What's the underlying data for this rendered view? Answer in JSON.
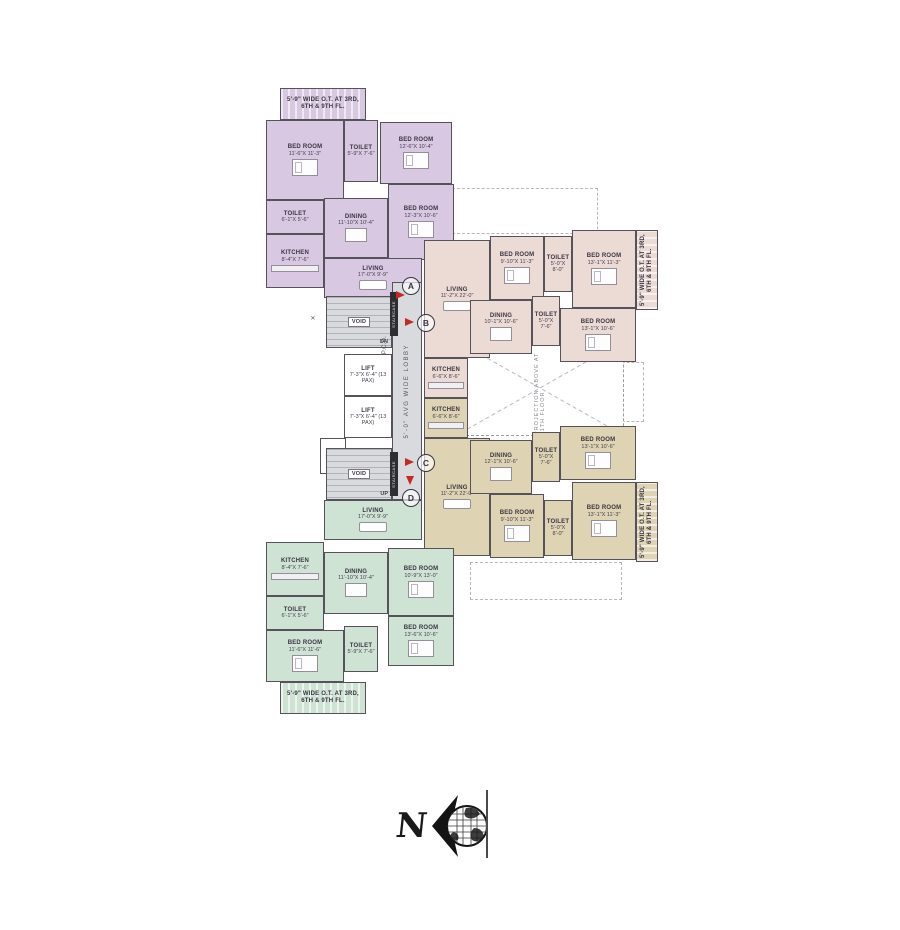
{
  "colors": {
    "purple": "#d9c8e1",
    "pink": "#ecdad5",
    "tan": "#ded3b2",
    "green": "#cfe3d5",
    "core": "#d8dadd",
    "wall": "#56525c",
    "arrow_red": "#c32a21"
  },
  "units": [
    {
      "id": "unit-a",
      "colorKey": "purple",
      "rooms": [
        {
          "name": "5'-9\" WIDE O.T. AT 3RD, 6TH & 9TH FL.",
          "dims": "",
          "type": "balcony",
          "x": 280,
          "y": 88,
          "w": 86,
          "h": 32
        },
        {
          "name": "BED ROOM",
          "dims": "11'-6\"X 11'-3\"",
          "type": "bedroom",
          "x": 266,
          "y": 120,
          "w": 78,
          "h": 80
        },
        {
          "name": "TOILET",
          "dims": "5'-9\"X 7'-6\"",
          "type": "toilet",
          "x": 344,
          "y": 120,
          "w": 34,
          "h": 62
        },
        {
          "name": "BED ROOM",
          "dims": "12'-6\"X 10'-4\"",
          "type": "bedroom",
          "x": 380,
          "y": 122,
          "w": 72,
          "h": 62
        },
        {
          "name": "TOILET",
          "dims": "6'-1\"X 5'-6\"",
          "type": "toilet",
          "x": 266,
          "y": 200,
          "w": 58,
          "h": 34
        },
        {
          "name": "KITCHEN",
          "dims": "8'-4\"X 7'-6\"",
          "type": "kitchen",
          "x": 266,
          "y": 234,
          "w": 58,
          "h": 54
        },
        {
          "name": "DINING",
          "dims": "11'-10\"X 10'-4\"",
          "type": "dining",
          "x": 324,
          "y": 198,
          "w": 64,
          "h": 60
        },
        {
          "name": "BED ROOM",
          "dims": "12'-3\"X 10'-6\"",
          "type": "bedroom",
          "x": 388,
          "y": 184,
          "w": 66,
          "h": 76
        },
        {
          "name": "LIVING",
          "dims": "17'-0\"X 9'-9\"",
          "type": "living",
          "x": 324,
          "y": 258,
          "w": 98,
          "h": 40
        }
      ]
    },
    {
      "id": "unit-b",
      "colorKey": "pink",
      "rooms": [
        {
          "name": "LIVING",
          "dims": "11'-2\"X 22'-0\"",
          "type": "living",
          "x": 424,
          "y": 240,
          "w": 66,
          "h": 118
        },
        {
          "name": "BED ROOM",
          "dims": "9'-10\"X 11'-3\"",
          "type": "bedroom",
          "x": 490,
          "y": 236,
          "w": 54,
          "h": 64
        },
        {
          "name": "TOILET",
          "dims": "5'-0\"X 8'-0\"",
          "type": "toilet",
          "x": 544,
          "y": 236,
          "w": 28,
          "h": 56
        },
        {
          "name": "BED ROOM",
          "dims": "13'-1\"X 11'-3\"",
          "type": "bedroom",
          "x": 572,
          "y": 230,
          "w": 64,
          "h": 78
        },
        {
          "name": "DINING",
          "dims": "10'-1\"X 10'-6\"",
          "type": "dining",
          "x": 470,
          "y": 300,
          "w": 62,
          "h": 54
        },
        {
          "name": "TOILET",
          "dims": "5'-0\"X 7'-6\"",
          "type": "toilet",
          "x": 532,
          "y": 296,
          "w": 28,
          "h": 50
        },
        {
          "name": "BED ROOM",
          "dims": "13'-1\"X 10'-6\"",
          "type": "bedroom",
          "x": 560,
          "y": 308,
          "w": 76,
          "h": 54
        },
        {
          "name": "KITCHEN",
          "dims": "6'-6\"X 8'-6\"",
          "type": "kitchen",
          "x": 424,
          "y": 358,
          "w": 44,
          "h": 40
        },
        {
          "name": "5'-9\" WIDE O.T. AT 3RD, 6TH & 9TH FL.",
          "dims": "",
          "type": "balcony",
          "vertical": true,
          "x": 636,
          "y": 230,
          "w": 22,
          "h": 80
        }
      ]
    },
    {
      "id": "unit-c",
      "colorKey": "tan",
      "rooms": [
        {
          "name": "KITCHEN",
          "dims": "6'-6\"X 8'-6\"",
          "type": "kitchen",
          "x": 424,
          "y": 398,
          "w": 44,
          "h": 40
        },
        {
          "name": "LIVING",
          "dims": "11'-2\"X 22'-0\"",
          "type": "living",
          "x": 424,
          "y": 438,
          "w": 66,
          "h": 118
        },
        {
          "name": "DINING",
          "dims": "12'-1\"X 10'-6\"",
          "type": "dining",
          "x": 470,
          "y": 440,
          "w": 62,
          "h": 54
        },
        {
          "name": "TOILET",
          "dims": "5'-0\"X 7'-6\"",
          "type": "toilet",
          "x": 532,
          "y": 432,
          "w": 28,
          "h": 50
        },
        {
          "name": "BED ROOM",
          "dims": "13'-1\"X 10'-6\"",
          "type": "bedroom",
          "x": 560,
          "y": 426,
          "w": 76,
          "h": 54
        },
        {
          "name": "BED ROOM",
          "dims": "9'-10\"X 11'-3\"",
          "type": "bedroom",
          "x": 490,
          "y": 494,
          "w": 54,
          "h": 64
        },
        {
          "name": "TOILET",
          "dims": "5'-0\"X 8'-0\"",
          "type": "toilet",
          "x": 544,
          "y": 500,
          "w": 28,
          "h": 56
        },
        {
          "name": "BED ROOM",
          "dims": "13'-1\"X 11'-3\"",
          "type": "bedroom",
          "x": 572,
          "y": 482,
          "w": 64,
          "h": 78
        },
        {
          "name": "5'-9\" WIDE O.T. AT 3RD, 6TH & 9TH FL.",
          "dims": "",
          "type": "balcony",
          "vertical": true,
          "x": 636,
          "y": 482,
          "w": 22,
          "h": 80
        }
      ]
    },
    {
      "id": "unit-d",
      "colorKey": "green",
      "rooms": [
        {
          "name": "LIVING",
          "dims": "17'-0\"X 9'-9\"",
          "type": "living",
          "x": 324,
          "y": 500,
          "w": 98,
          "h": 40
        },
        {
          "name": "KITCHEN",
          "dims": "8'-4\"X 7'-6\"",
          "type": "kitchen",
          "x": 266,
          "y": 542,
          "w": 58,
          "h": 54
        },
        {
          "name": "DINING",
          "dims": "11'-10\"X 10'-4\"",
          "type": "dining",
          "x": 324,
          "y": 552,
          "w": 64,
          "h": 62
        },
        {
          "name": "BED ROOM",
          "dims": "10'-9\"X 13'-0\"",
          "type": "bedroom",
          "x": 388,
          "y": 548,
          "w": 66,
          "h": 68
        },
        {
          "name": "TOILET",
          "dims": "6'-1\"X 5'-6\"",
          "type": "toilet",
          "x": 266,
          "y": 596,
          "w": 58,
          "h": 34
        },
        {
          "name": "BED ROOM",
          "dims": "13'-6\"X 10'-6\"",
          "type": "bedroom",
          "x": 388,
          "y": 616,
          "w": 66,
          "h": 50
        },
        {
          "name": "BED ROOM",
          "dims": "11'-6\"X 11'-6\"",
          "type": "bedroom",
          "x": 266,
          "y": 630,
          "w": 78,
          "h": 52
        },
        {
          "name": "TOILET",
          "dims": "5'-9\"X 7'-6\"",
          "type": "toilet",
          "x": 344,
          "y": 626,
          "w": 34,
          "h": 46
        },
        {
          "name": "5'-9\" WIDE O.T. AT 3RD, 6TH & 9TH FL.",
          "dims": "",
          "type": "balcony",
          "x": 280,
          "y": 682,
          "w": 86,
          "h": 32
        }
      ]
    }
  ],
  "core": {
    "colorKey": "core",
    "rooms": [
      {
        "name": "VOID",
        "dims": "DN",
        "type": "stair",
        "x": 326,
        "y": 296,
        "w": 66,
        "h": 52
      },
      {
        "name": "LIFT",
        "dims": "7'-3\"X 6'-4\" (13 PAX)",
        "type": "lift",
        "x": 344,
        "y": 354,
        "w": 48,
        "h": 42
      },
      {
        "name": "LIFT",
        "dims": "7'-3\"X 6'-4\" (13 PAX)",
        "type": "lift",
        "x": 344,
        "y": 396,
        "w": 48,
        "h": 42
      },
      {
        "name": "FIRE DUCT",
        "dims": "",
        "type": "duct",
        "x": 320,
        "y": 438,
        "w": 26,
        "h": 36
      },
      {
        "name": "VOID",
        "dims": "UP",
        "type": "stair",
        "x": 326,
        "y": 448,
        "w": 66,
        "h": 52
      },
      {
        "name": "5'-0\" AVG WIDE LOBBY",
        "dims": "",
        "type": "lobby",
        "vertical": true,
        "x": 392,
        "y": 282,
        "w": 30,
        "h": 218
      },
      {
        "name": "P.C.D.",
        "dims": "",
        "type": "note",
        "vertical": true,
        "x": 380,
        "y": 330,
        "w": 11,
        "h": 30
      },
      {
        "name": "✕",
        "dims": "",
        "type": "note",
        "x": 300,
        "y": 306,
        "w": 26,
        "h": 26
      },
      {
        "name": "STAIRCASE",
        "dims": "",
        "type": "bar",
        "vertical": true,
        "x": 390,
        "y": 292,
        "w": 8,
        "h": 44
      },
      {
        "name": "STAIRCASE",
        "dims": "",
        "type": "bar",
        "vertical": true,
        "x": 390,
        "y": 452,
        "w": 8,
        "h": 44
      }
    ]
  },
  "markers": [
    {
      "label": "A",
      "x": 402,
      "y": 277,
      "arrow": {
        "x": 396,
        "y": 291,
        "dir": "right"
      }
    },
    {
      "label": "B",
      "x": 417,
      "y": 314,
      "arrow": {
        "x": 405,
        "y": 318,
        "dir": "right"
      }
    },
    {
      "label": "C",
      "x": 417,
      "y": 454,
      "arrow": {
        "x": 405,
        "y": 458,
        "dir": "right"
      }
    },
    {
      "label": "D",
      "x": 402,
      "y": 489,
      "arrow": {
        "x": 406,
        "y": 476,
        "dir": "down"
      }
    }
  ],
  "projection": {
    "label": "PROJECTION ABOVE AT 11TH FLOOR"
  },
  "compass": {
    "letter": "N"
  }
}
